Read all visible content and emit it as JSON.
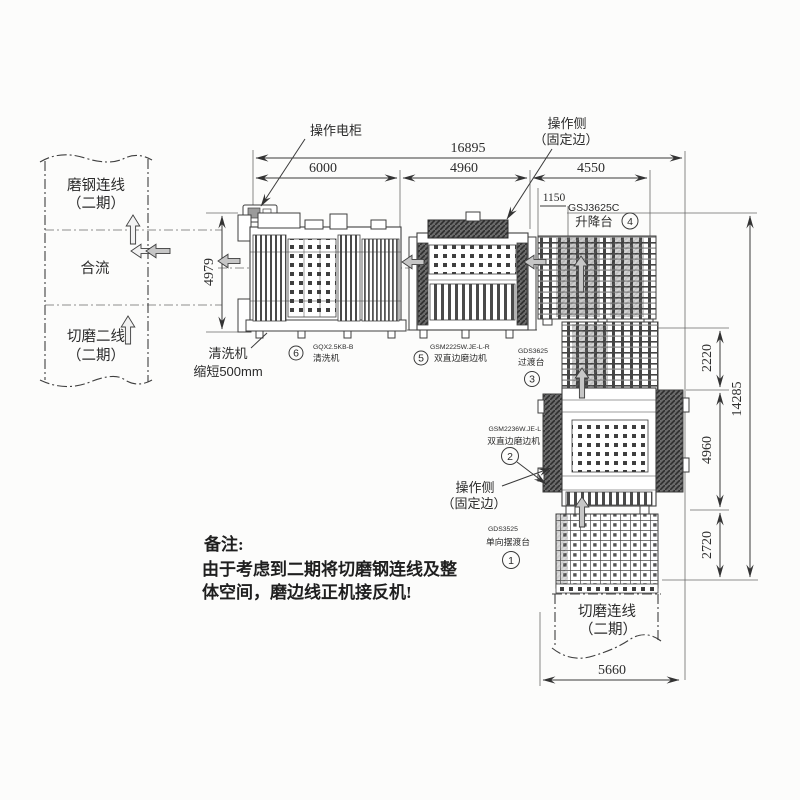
{
  "colors": {
    "ink": "#3a3a3a",
    "paper": "#fcfcfb",
    "arrow_gray": "#c6c6c6"
  },
  "left_flow": {
    "top1": "磨钢连线",
    "top2": "（二期）",
    "mid": "合流",
    "bot1": "切磨二线",
    "bot2": "（二期）"
  },
  "bottom_flow": {
    "l1": "切磨连线",
    "l2": "（二期）"
  },
  "dims": {
    "total": "16895",
    "seg1": "6000",
    "seg2": "4960",
    "seg3": "4550",
    "offset": "1150",
    "left_h": "4979",
    "r1": "2220",
    "r2": "4960",
    "r3": "2720",
    "r_total": "14285",
    "bottom": "5660"
  },
  "callouts": {
    "cabinet": "操作电柜",
    "op_top1": "操作侧",
    "op_top2": "（固定边）",
    "op_bot1": "操作侧",
    "op_bot2": "（固定边）",
    "wash1": "清洗机",
    "wash2": "缩短500mm"
  },
  "machines": {
    "m4": {
      "model": "GSJ3625C",
      "name": "升降台",
      "no": "4"
    },
    "m6": {
      "model": "GQX2.5KB-B",
      "name": "清洗机",
      "no": "6"
    },
    "m5": {
      "model": "GSM2225W.JE-L-R",
      "name": "双直边磨边机",
      "no": "5"
    },
    "m3": {
      "model": "GDS3625",
      "name": "过渡台",
      "no": "3"
    },
    "m2": {
      "model": "GSM2236W.JE-L",
      "name": "双直边磨边机",
      "no": "2"
    },
    "m1": {
      "model": "GDS3525",
      "name": "单向摆渡台",
      "no": "1"
    }
  },
  "note": {
    "title": "备注:",
    "line1": "由于考虑到二期将切磨钢连线及整",
    "line2": "体空间，磨边线正机接反机!"
  }
}
